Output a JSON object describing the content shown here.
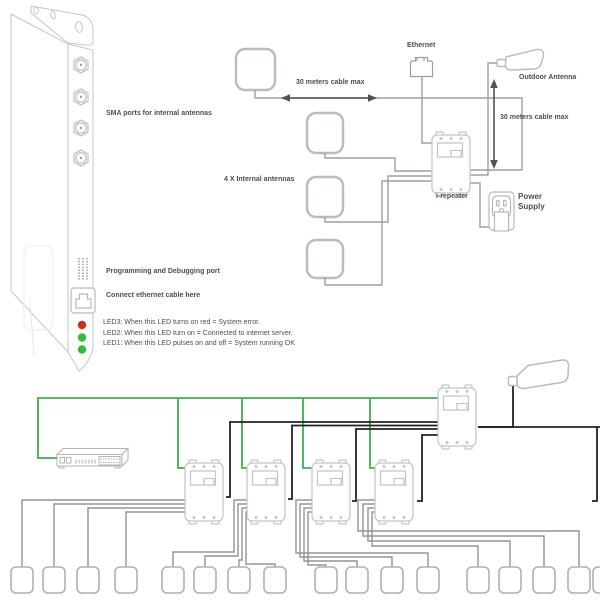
{
  "colors": {
    "green_wire": "#3fae49",
    "black_wire": "#222222",
    "gray_wire": "#8f9595",
    "top_wire": "#9aa0a0",
    "arrow": "#4f5355",
    "led_red": "#d42a1e",
    "led_green": "#2ebf3c",
    "box_border": "#c0c5c5",
    "text": "#4a4f52"
  },
  "icons": {
    "sma_port": "hexagon coax connector",
    "programming_port": "pin-header dot grid",
    "ethernet_jack": "RJ45 socket",
    "ethernet_plug": "RJ45 plug",
    "outdoor_antenna": "paddle antenna",
    "power_outlet": "wall socket with adapter",
    "network_switch": "rack switch",
    "repeater": "wall-mount repeater box",
    "ceiling_antenna": "small square antenna"
  },
  "device_panel": {
    "sma_label": "SMA ports for internal antennas",
    "programming_label": "Programming and Debugging port",
    "ethernet_label": "Connect ethernet cable here",
    "led3": "LED3: When  this LED turns on red = System error.",
    "led2": "LED2: When this LED turn on = Connected to internet server.",
    "led1": "LED1: When this LED pulses on and off = System running OK"
  },
  "top_diagram": {
    "internal_antennas_label": "4 X  Internal antennas",
    "horizontal_cable_label": "30 meters cable max",
    "vertical_cable_label": "30 meters cable max",
    "ethernet_label": "Ethernet",
    "outdoor_antenna_label": "Outdoor Antenna",
    "repeater_label": "i-repeater",
    "power_label": "Power",
    "supply_label": "Supply"
  }
}
